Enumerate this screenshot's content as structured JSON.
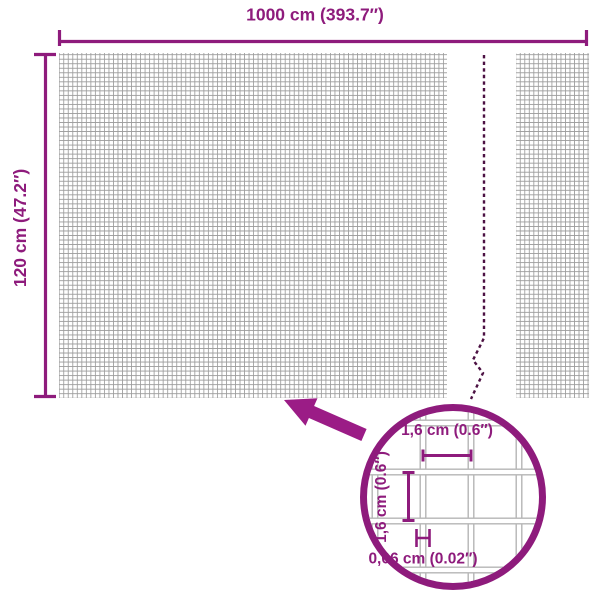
{
  "canvas": {
    "width": 600,
    "height": 600,
    "background": "#ffffff"
  },
  "colors": {
    "accent": "#8e1b7c",
    "arrow": "#9b1c86",
    "break_line": "#4c1143",
    "mesh_line": "#9c9c9c",
    "wire_edge": "#b5b5b5"
  },
  "dimensions": {
    "total_width_label": "1000 cm (393.7″)",
    "total_height_label": "120 cm (47.2″)"
  },
  "inset": {
    "mesh_width_label": "1,6 cm (0.6″)",
    "mesh_height_label": "1,6 cm (0.6″)",
    "wire_thickness_label": "0,06 cm (0.02″)"
  }
}
